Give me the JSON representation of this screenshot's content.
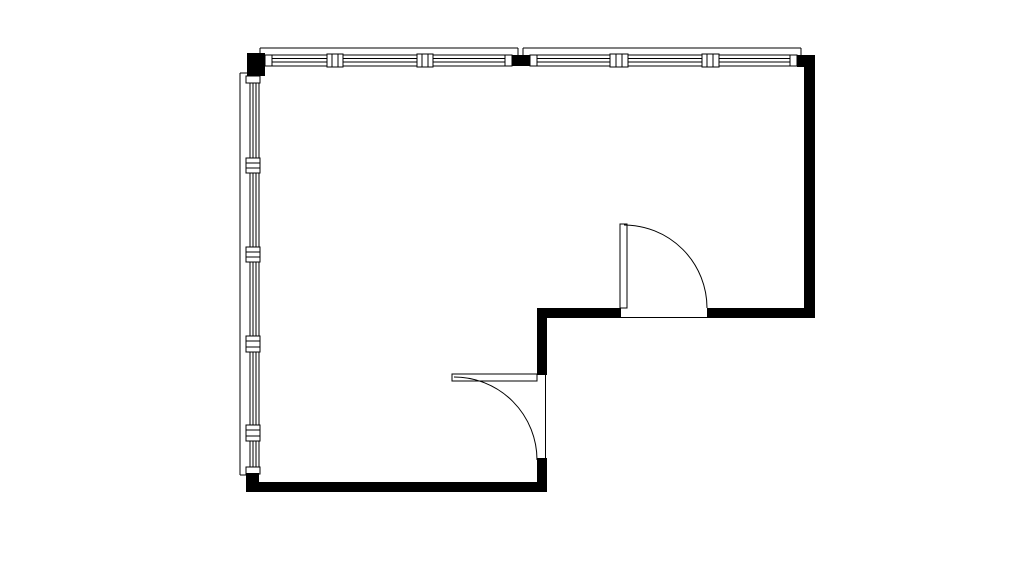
{
  "meta": {
    "description": "architectural-floor-plan",
    "background": "#ffffff",
    "ink": "#000000",
    "canvas": {
      "width": 1026,
      "height": 576
    }
  },
  "plan": {
    "window_bands": [
      {
        "name": "window-band-top-left",
        "x": 265,
        "y": 55,
        "w": 247,
        "h": 11
      },
      {
        "name": "window-band-top-right",
        "x": 530,
        "y": 55,
        "w": 267,
        "h": 11
      },
      {
        "name": "window-band-left",
        "x": 250,
        "y": 76,
        "w": 9,
        "h": 398
      }
    ],
    "glazing_lines": [
      {
        "x1": 265,
        "y1": 58.5,
        "x2": 512,
        "y2": 58.5
      },
      {
        "x1": 265,
        "y1": 62,
        "x2": 512,
        "y2": 62
      },
      {
        "x1": 530,
        "y1": 58.5,
        "x2": 797,
        "y2": 58.5
      },
      {
        "x1": 530,
        "y1": 62,
        "x2": 797,
        "y2": 62
      },
      {
        "x1": 253,
        "y1": 76,
        "x2": 253,
        "y2": 474
      },
      {
        "x1": 256,
        "y1": 76,
        "x2": 256,
        "y2": 474
      }
    ],
    "window_fittings": [
      {
        "name": "window-end-cap",
        "x": 265,
        "y": 55,
        "w": 7,
        "h": 11
      },
      {
        "name": "window-end-cap",
        "x": 505,
        "y": 55,
        "w": 7,
        "h": 11
      },
      {
        "name": "window-end-cap",
        "x": 530,
        "y": 55,
        "w": 7,
        "h": 11
      },
      {
        "name": "window-end-cap",
        "x": 790,
        "y": 55,
        "w": 7,
        "h": 11
      },
      {
        "name": "window-end-cap",
        "x": 246,
        "y": 76,
        "w": 14,
        "h": 7
      },
      {
        "name": "window-end-cap",
        "x": 246,
        "y": 467,
        "w": 14,
        "h": 7
      },
      {
        "name": "window-mullion",
        "x": 327,
        "y": 54,
        "w": 16,
        "h": 13
      },
      {
        "name": "window-mullion",
        "x": 417,
        "y": 54,
        "w": 16,
        "h": 13
      },
      {
        "name": "window-mullion",
        "x": 610,
        "y": 54,
        "w": 18,
        "h": 13
      },
      {
        "name": "window-mullion",
        "x": 702,
        "y": 54,
        "w": 17,
        "h": 13
      },
      {
        "name": "window-mullion",
        "x": 246,
        "y": 158,
        "w": 14,
        "h": 15
      },
      {
        "name": "window-mullion",
        "x": 246,
        "y": 247,
        "w": 14,
        "h": 15
      },
      {
        "name": "window-mullion",
        "x": 246,
        "y": 336,
        "w": 14,
        "h": 16
      },
      {
        "name": "window-mullion",
        "x": 246,
        "y": 425,
        "w": 14,
        "h": 16
      }
    ],
    "fitting_lines": [
      {
        "x1": 332,
        "y1": 54,
        "x2": 332,
        "y2": 67
      },
      {
        "x1": 338,
        "y1": 54,
        "x2": 338,
        "y2": 67
      },
      {
        "x1": 422,
        "y1": 54,
        "x2": 422,
        "y2": 67
      },
      {
        "x1": 428,
        "y1": 54,
        "x2": 428,
        "y2": 67
      },
      {
        "x1": 616,
        "y1": 54,
        "x2": 616,
        "y2": 67
      },
      {
        "x1": 622,
        "y1": 54,
        "x2": 622,
        "y2": 67
      },
      {
        "x1": 707,
        "y1": 54,
        "x2": 707,
        "y2": 67
      },
      {
        "x1": 713,
        "y1": 54,
        "x2": 713,
        "y2": 67
      },
      {
        "x1": 246,
        "y1": 163,
        "x2": 260,
        "y2": 163
      },
      {
        "x1": 246,
        "y1": 168,
        "x2": 260,
        "y2": 168
      },
      {
        "x1": 246,
        "y1": 252,
        "x2": 260,
        "y2": 252
      },
      {
        "x1": 246,
        "y1": 257,
        "x2": 260,
        "y2": 257
      },
      {
        "x1": 246,
        "y1": 341,
        "x2": 260,
        "y2": 341
      },
      {
        "x1": 246,
        "y1": 347,
        "x2": 260,
        "y2": 347
      },
      {
        "x1": 246,
        "y1": 430,
        "x2": 260,
        "y2": 430
      },
      {
        "x1": 246,
        "y1": 436,
        "x2": 260,
        "y2": 436
      }
    ],
    "walls": [
      {
        "name": "wall-corner-top-left",
        "x": 247,
        "y": 53,
        "w": 18,
        "h": 23
      },
      {
        "name": "wall-pier-top-middle",
        "x": 512,
        "y": 55,
        "w": 18,
        "h": 11
      },
      {
        "name": "wall-corner-top-right",
        "x": 797,
        "y": 55,
        "w": 18,
        "h": 12
      },
      {
        "name": "wall-right",
        "x": 804,
        "y": 55,
        "w": 11,
        "h": 263
      },
      {
        "name": "wall-mid-horizontal-left",
        "x": 537,
        "y": 308,
        "w": 84,
        "h": 10
      },
      {
        "name": "wall-mid-horizontal-right",
        "x": 707,
        "y": 308,
        "w": 108,
        "h": 10
      },
      {
        "name": "wall-step-vertical-upper",
        "x": 537,
        "y": 318,
        "w": 10,
        "h": 57
      },
      {
        "name": "wall-step-vertical-lower",
        "x": 537,
        "y": 458,
        "w": 10,
        "h": 34
      },
      {
        "name": "wall-bottom",
        "x": 246,
        "y": 482,
        "w": 301,
        "h": 10
      },
      {
        "name": "wall-corner-bottom-left",
        "x": 246,
        "y": 473,
        "w": 13,
        "h": 19
      }
    ],
    "outline_lines": [
      {
        "x1": 260,
        "y1": 48,
        "x2": 518,
        "y2": 48
      },
      {
        "x1": 260,
        "y1": 48,
        "x2": 260,
        "y2": 53
      },
      {
        "x1": 518,
        "y1": 48,
        "x2": 518,
        "y2": 55
      },
      {
        "x1": 523,
        "y1": 48,
        "x2": 801,
        "y2": 48
      },
      {
        "x1": 523,
        "y1": 48,
        "x2": 523,
        "y2": 55
      },
      {
        "x1": 801,
        "y1": 48,
        "x2": 801,
        "y2": 55
      },
      {
        "x1": 240,
        "y1": 73,
        "x2": 240,
        "y2": 475
      },
      {
        "x1": 240,
        "y1": 73,
        "x2": 247,
        "y2": 73
      },
      {
        "x1": 240,
        "y1": 475,
        "x2": 247,
        "y2": 475
      }
    ],
    "doors": [
      {
        "name": "door-upper-room",
        "leaf": {
          "x": 620,
          "y": 224,
          "w": 7,
          "h": 84
        },
        "arc": "M 624 225 A 83 83 0 0 1 707 308",
        "threshold": {
          "x1": 621,
          "y1": 317.5,
          "x2": 707,
          "y2": 317.5
        }
      },
      {
        "name": "door-lower-room",
        "leaf": {
          "x": 452,
          "y": 374,
          "w": 85,
          "h": 7
        },
        "arc": "M 454 377 A 83 83 0 0 1 537 460",
        "threshold": {
          "x1": 545.5,
          "y1": 375,
          "x2": 545.5,
          "y2": 458
        }
      }
    ]
  }
}
